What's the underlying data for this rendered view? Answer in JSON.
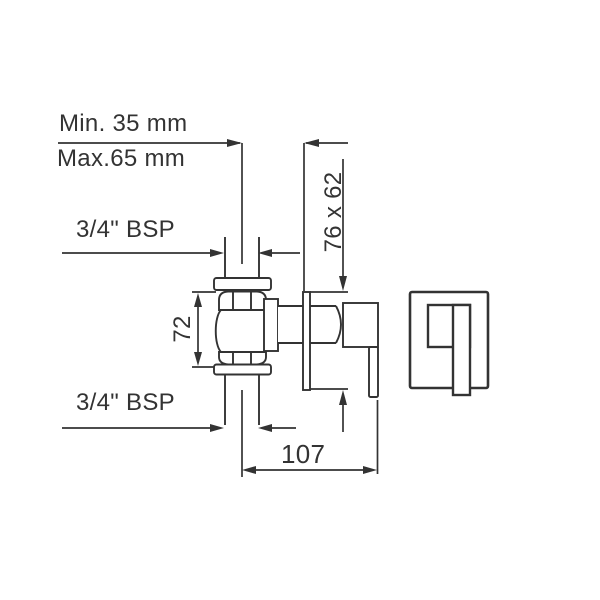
{
  "drawing": {
    "title": "concealed-valve-technical-drawing",
    "labels": {
      "min_depth": "Min. 35 mm",
      "max_depth": "Max.65 mm",
      "bsp_top": "3/4\" BSP",
      "bsp_bottom": "3/4\" BSP",
      "body_height": "72",
      "plate_size": "76 x 62",
      "overall_depth": "107"
    },
    "colors": {
      "line": "#333333",
      "text": "#333333",
      "background": "#ffffff"
    }
  }
}
